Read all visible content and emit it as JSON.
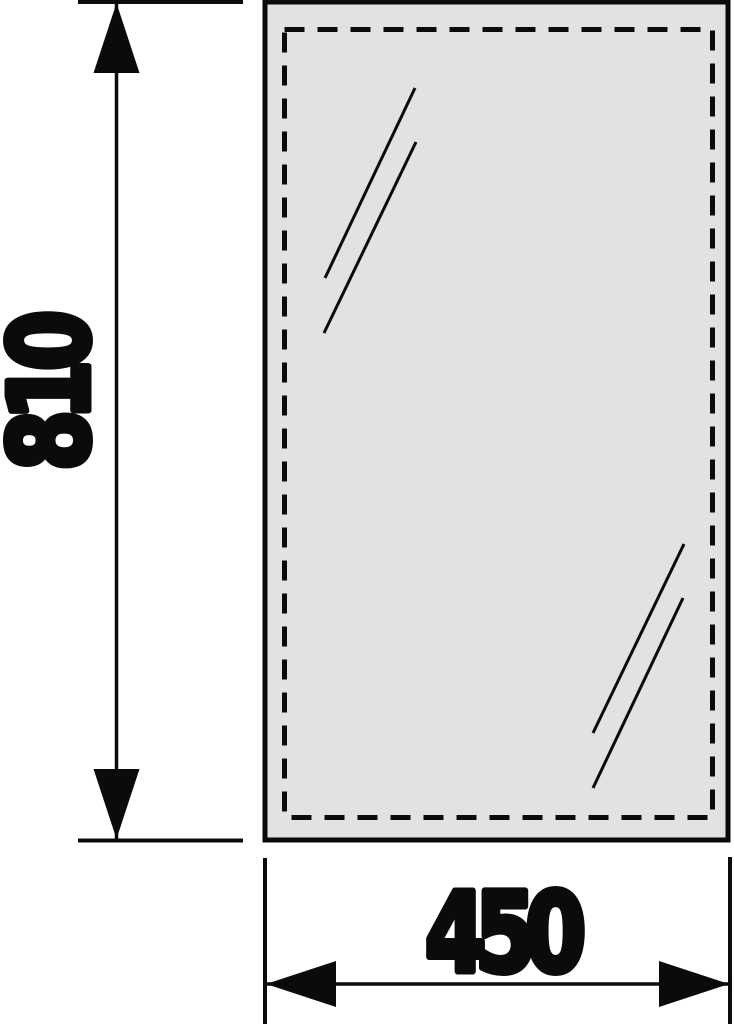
{
  "drawing": {
    "title": "mirror-panel-dimension-drawing",
    "height_dimension": {
      "value": "810"
    },
    "width_dimension": {
      "value": "450"
    }
  },
  "colors": {
    "background": "#ffffff",
    "panel_fill": "#e0e3e1",
    "line": "#0b0b0b"
  }
}
